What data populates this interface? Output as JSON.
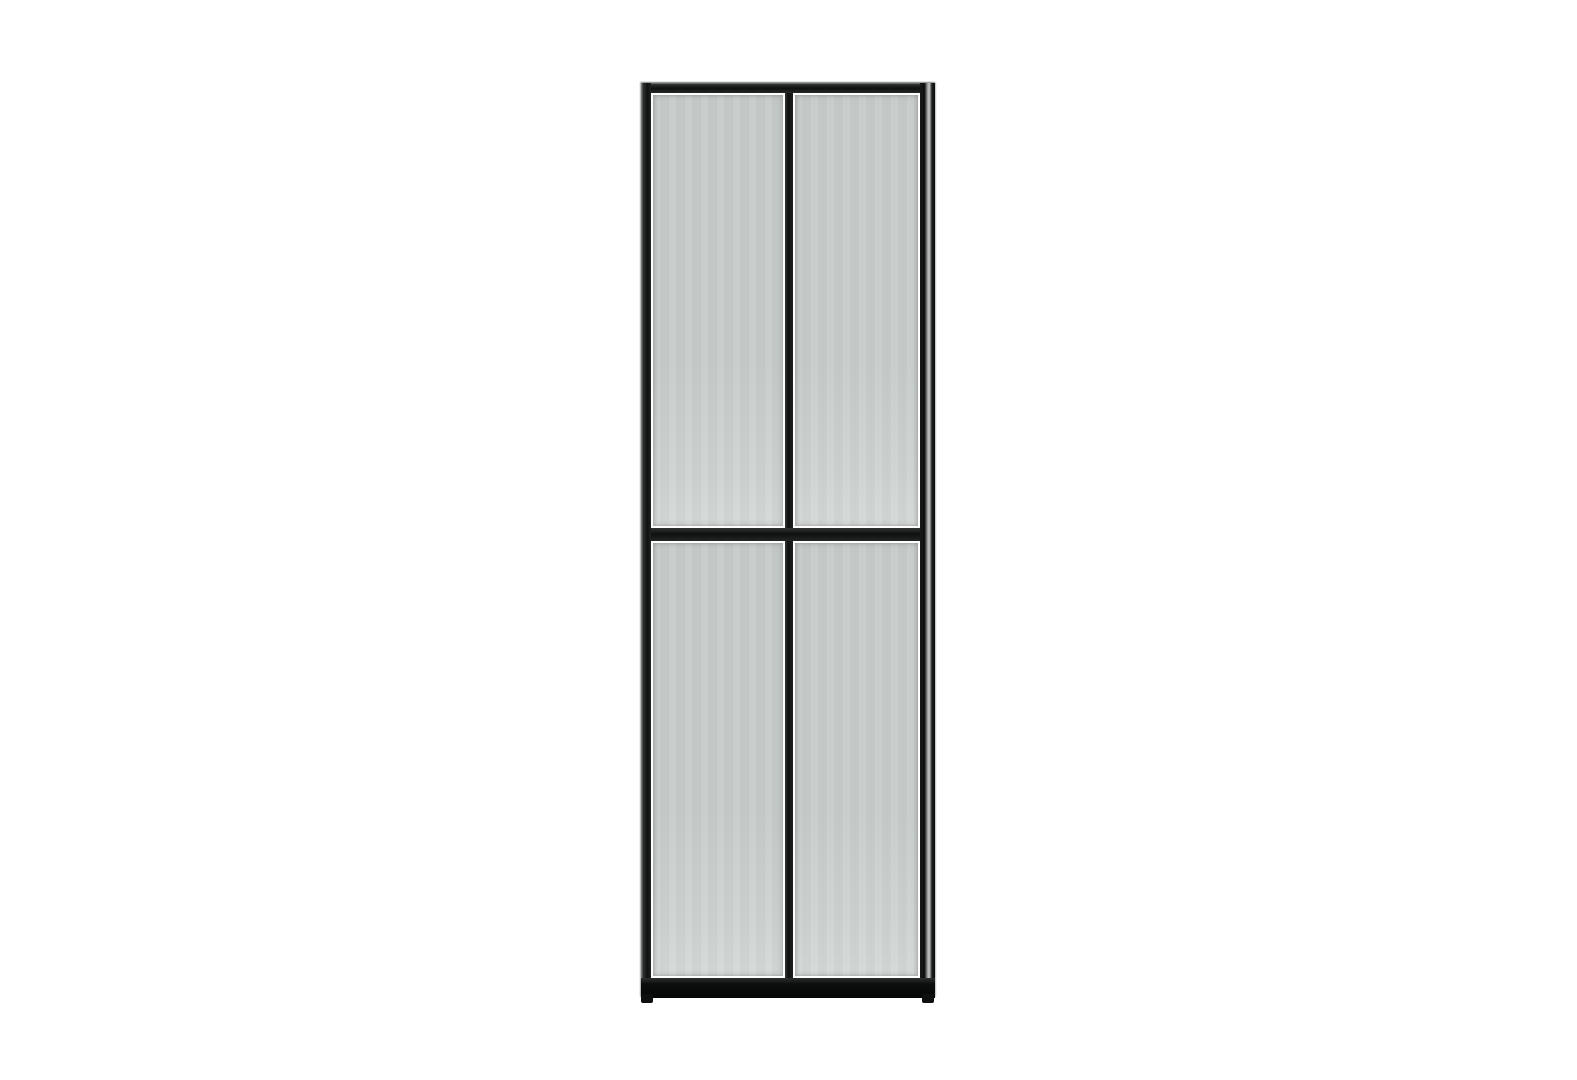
{
  "scene": {
    "background_color": "#ffffff"
  },
  "cabinet": {
    "kind": "glass-door-display-cabinet",
    "colors": {
      "frame": "#1b1d1c",
      "frame_dark": "#0e100f",
      "glass": "#c7ccca",
      "seam": "#fdfdfd",
      "highlight": "#a9aba9",
      "background": "#ffffff"
    },
    "frame_members": [
      {
        "id": "top-rail"
      },
      {
        "id": "left-stile"
      },
      {
        "id": "right-stile"
      },
      {
        "id": "center-stile"
      },
      {
        "id": "middle-rail"
      },
      {
        "id": "plinth-base"
      },
      {
        "id": "left-foot"
      },
      {
        "id": "right-foot"
      }
    ],
    "glass_doors": [
      {
        "id": "top-left"
      },
      {
        "id": "top-right"
      },
      {
        "id": "bottom-left"
      },
      {
        "id": "bottom-right"
      }
    ]
  }
}
